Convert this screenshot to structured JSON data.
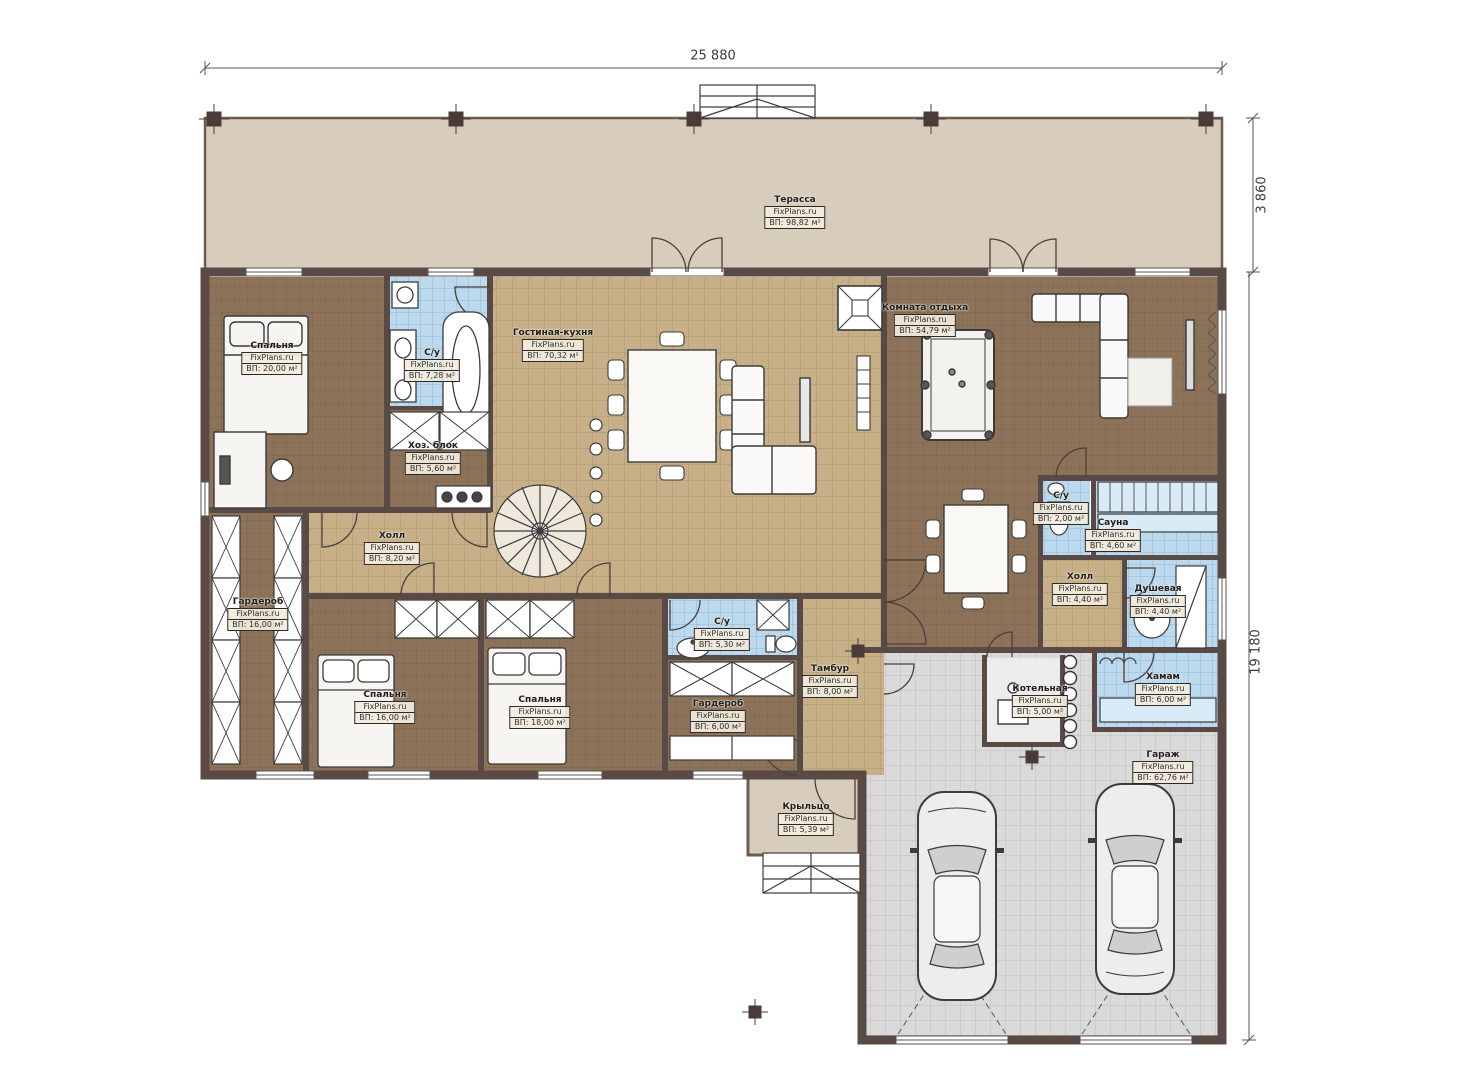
{
  "brand": "FixPlans.ru",
  "dimensions": {
    "width_top": "25 880",
    "terrace_depth": "3 860",
    "height_right": "19 180"
  },
  "rooms": {
    "terrace": {
      "name": "Терасса",
      "area": "ВП: 98,82 м²"
    },
    "bedroom1": {
      "name": "Спальня",
      "area": "ВП: 20,00 м²"
    },
    "bathroom1": {
      "name": "С/у",
      "area": "ВП: 7,28 м²"
    },
    "utility": {
      "name": "Хоз. блок",
      "area": "ВП: 5,60 м²"
    },
    "living": {
      "name": "Гостиная-кухня",
      "area": "ВП: 70,32 м²"
    },
    "lounge": {
      "name": "Комната отдыха",
      "area": "ВП: 54,79 м²"
    },
    "hall1": {
      "name": "Холл",
      "area": "ВП: 8,20 м²"
    },
    "wardrobe1": {
      "name": "Гардероб",
      "area": "ВП: 16,00 м²"
    },
    "bedroom2": {
      "name": "Спальня",
      "area": "ВП: 16,00 м²"
    },
    "bedroom3": {
      "name": "Спальня",
      "area": "ВП: 18,00 м²"
    },
    "bathroom2": {
      "name": "С/у",
      "area": "ВП: 5,30 м²"
    },
    "wardrobe2": {
      "name": "Гардероб",
      "area": "ВП: 6,00 м²"
    },
    "vestibule": {
      "name": "Тамбур",
      "area": "ВП: 8,00 м²"
    },
    "bathroom3": {
      "name": "С/у",
      "area": "ВП: 2,00 м²"
    },
    "sauna": {
      "name": "Сауна",
      "area": "ВП: 4,60 м²"
    },
    "hall2": {
      "name": "Холл",
      "area": "ВП: 4,40 м²"
    },
    "shower": {
      "name": "Душевая",
      "area": "ВП: 4,40 м²"
    },
    "hammam": {
      "name": "Хамам",
      "area": "ВП: 6,00 м²"
    },
    "boiler": {
      "name": "Котельная",
      "area": "ВП: 5,00 м²"
    },
    "garage": {
      "name": "Гараж",
      "area": "ВП: 62,76 м²"
    },
    "porch": {
      "name": "Крыльцо",
      "area": "ВП: 5,39 м²"
    }
  },
  "colors": {
    "wall": "#5a4a46",
    "wood_floor": "#8b7258",
    "tile_floor": "#c7b088",
    "wet_floor": "#bcd9ee",
    "garage_floor": "#dadada",
    "terrace_floor": "#d8ccbc"
  }
}
